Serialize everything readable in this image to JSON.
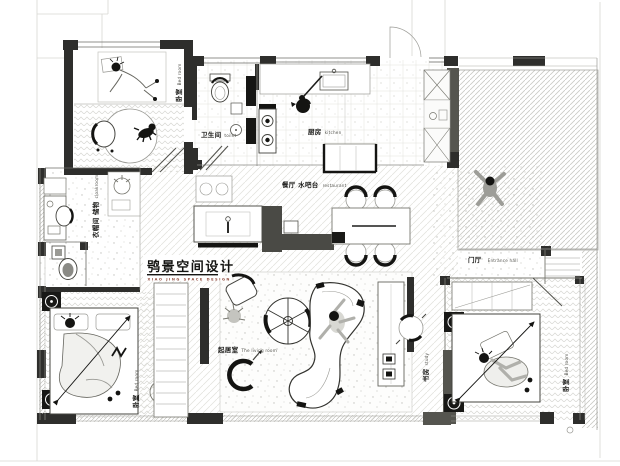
{
  "plan": {
    "title_note": "furnished apartment floor plan drawing"
  },
  "logo": {
    "cn": "鸮景空间设计",
    "en": "XIAO JING SPACE DESIGN"
  },
  "rooms": {
    "bedroom_top_left": {
      "cn": "卧室",
      "en": "Bed room"
    },
    "bathroom": {
      "cn": "卫生间",
      "en": "toilet"
    },
    "kitchen": {
      "cn": "厨房",
      "en": "kitchen"
    },
    "dining_bar": {
      "cn": "餐厅 水吧台",
      "en": "restaurant"
    },
    "entrance_hall": {
      "cn": "门厅",
      "en": "Entrance hall"
    },
    "cloakroom": {
      "cn": "衣帽间 储物",
      "en": "cloakroom"
    },
    "living_room": {
      "cn": "起居室",
      "en": "The living room"
    },
    "study": {
      "cn": "书房",
      "en": "study"
    },
    "bedroom_bottom_left": {
      "cn": "卧室",
      "en": "Bed room"
    },
    "bedroom_bottom_right": {
      "cn": "卧室",
      "en": "Bed room"
    }
  },
  "colors": {
    "wall_black": "#2e2e2c",
    "wall_gray": "#55554f",
    "hatch": "#cfcfca",
    "logo_accent": "#8f4a3c",
    "paper": "#ffffff"
  }
}
